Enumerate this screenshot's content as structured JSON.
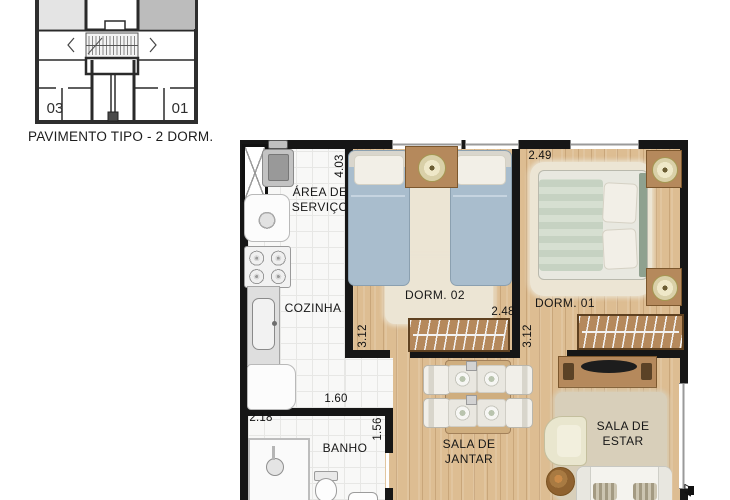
{
  "key_plan": {
    "unit_left": "03",
    "unit_right": "01",
    "caption": "PAVIMENTO TIPO - 2 DORM."
  },
  "rooms": {
    "area_servico": {
      "line1": "ÁREA DE",
      "line2": "SERVIÇO",
      "height_dim": "4.03"
    },
    "cozinha": {
      "label": "COZINHA",
      "width_dim": "1.60"
    },
    "dorm02": {
      "label": "DORM. 02",
      "width_dim": "2.48",
      "height_dim": "3.12"
    },
    "dorm01": {
      "label": "DORM. 01",
      "width_dim": "2.49",
      "height_dim": "3.12"
    },
    "banho": {
      "label": "BANHO",
      "width_dim": "2.18",
      "height_dim": "1.56"
    },
    "sala_jantar": {
      "line1": "SALA DE",
      "line2": "JANTAR"
    },
    "sala_estar": {
      "line1": "SALA DE",
      "line2": "ESTAR",
      "height_dim_partial": "47"
    }
  },
  "theme": {
    "wall": "#161616",
    "wood_floor": "#ddbd92",
    "tile": "#f8f8f7",
    "furniture_wood": "#b5895c",
    "rug_cream": "#ece5d4",
    "rug_beige": "#d8cfba",
    "bed_blue": "#a9bdcd",
    "bed_green": "#c6d2c2",
    "keyplan_light": "#e4e4e4",
    "keyplan_dark": "#bcbcbc"
  }
}
